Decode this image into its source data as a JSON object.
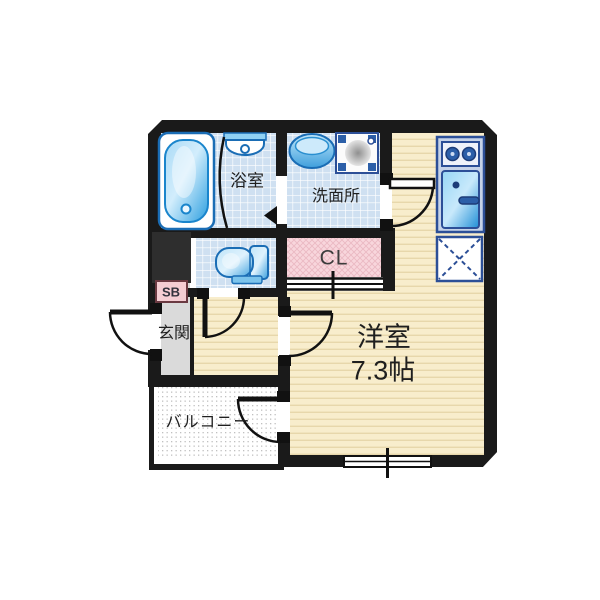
{
  "title": "1K apartment floor plan",
  "rooms": {
    "bathroom": {
      "label": "浴室"
    },
    "washroom": {
      "label": "洗面所"
    },
    "closet": {
      "label": "CL"
    },
    "shoe_box": {
      "label": "SB"
    },
    "entrance": {
      "label": "玄関"
    },
    "balcony": {
      "label": "バルコニー"
    },
    "main_room": {
      "label": "洋室",
      "size_label": "7.3帖"
    }
  },
  "fixtures": [
    "bathtub-icon",
    "bath-basin-icon",
    "vanity-sink-icon",
    "washer-pan-icon",
    "toilet-icon",
    "kitchen-stove-icon",
    "kitchen-sink-icon",
    "refrigerator-space-icon",
    "window-icon",
    "entrance-door-icon",
    "bathroom-door-icon",
    "washroom-door-icon",
    "toilet-door-icon",
    "mainroom-door-icon",
    "balcony-door-icon",
    "closet-sliding-door-icon"
  ],
  "colors": {
    "wall": "#1a1a1a",
    "wood_floor": "#f8edcc",
    "wood_line": "#e7d7ab",
    "tile_floor": "#cfe0f1",
    "closet_pink": "#f8d6dc",
    "entrance_gray": "#dadada",
    "fixture_blue": "#2ea2e2",
    "fixture_border": "#1a6db5",
    "kitchen_border": "#2c4f97",
    "shoebox_pink": "#f5cdd3"
  }
}
